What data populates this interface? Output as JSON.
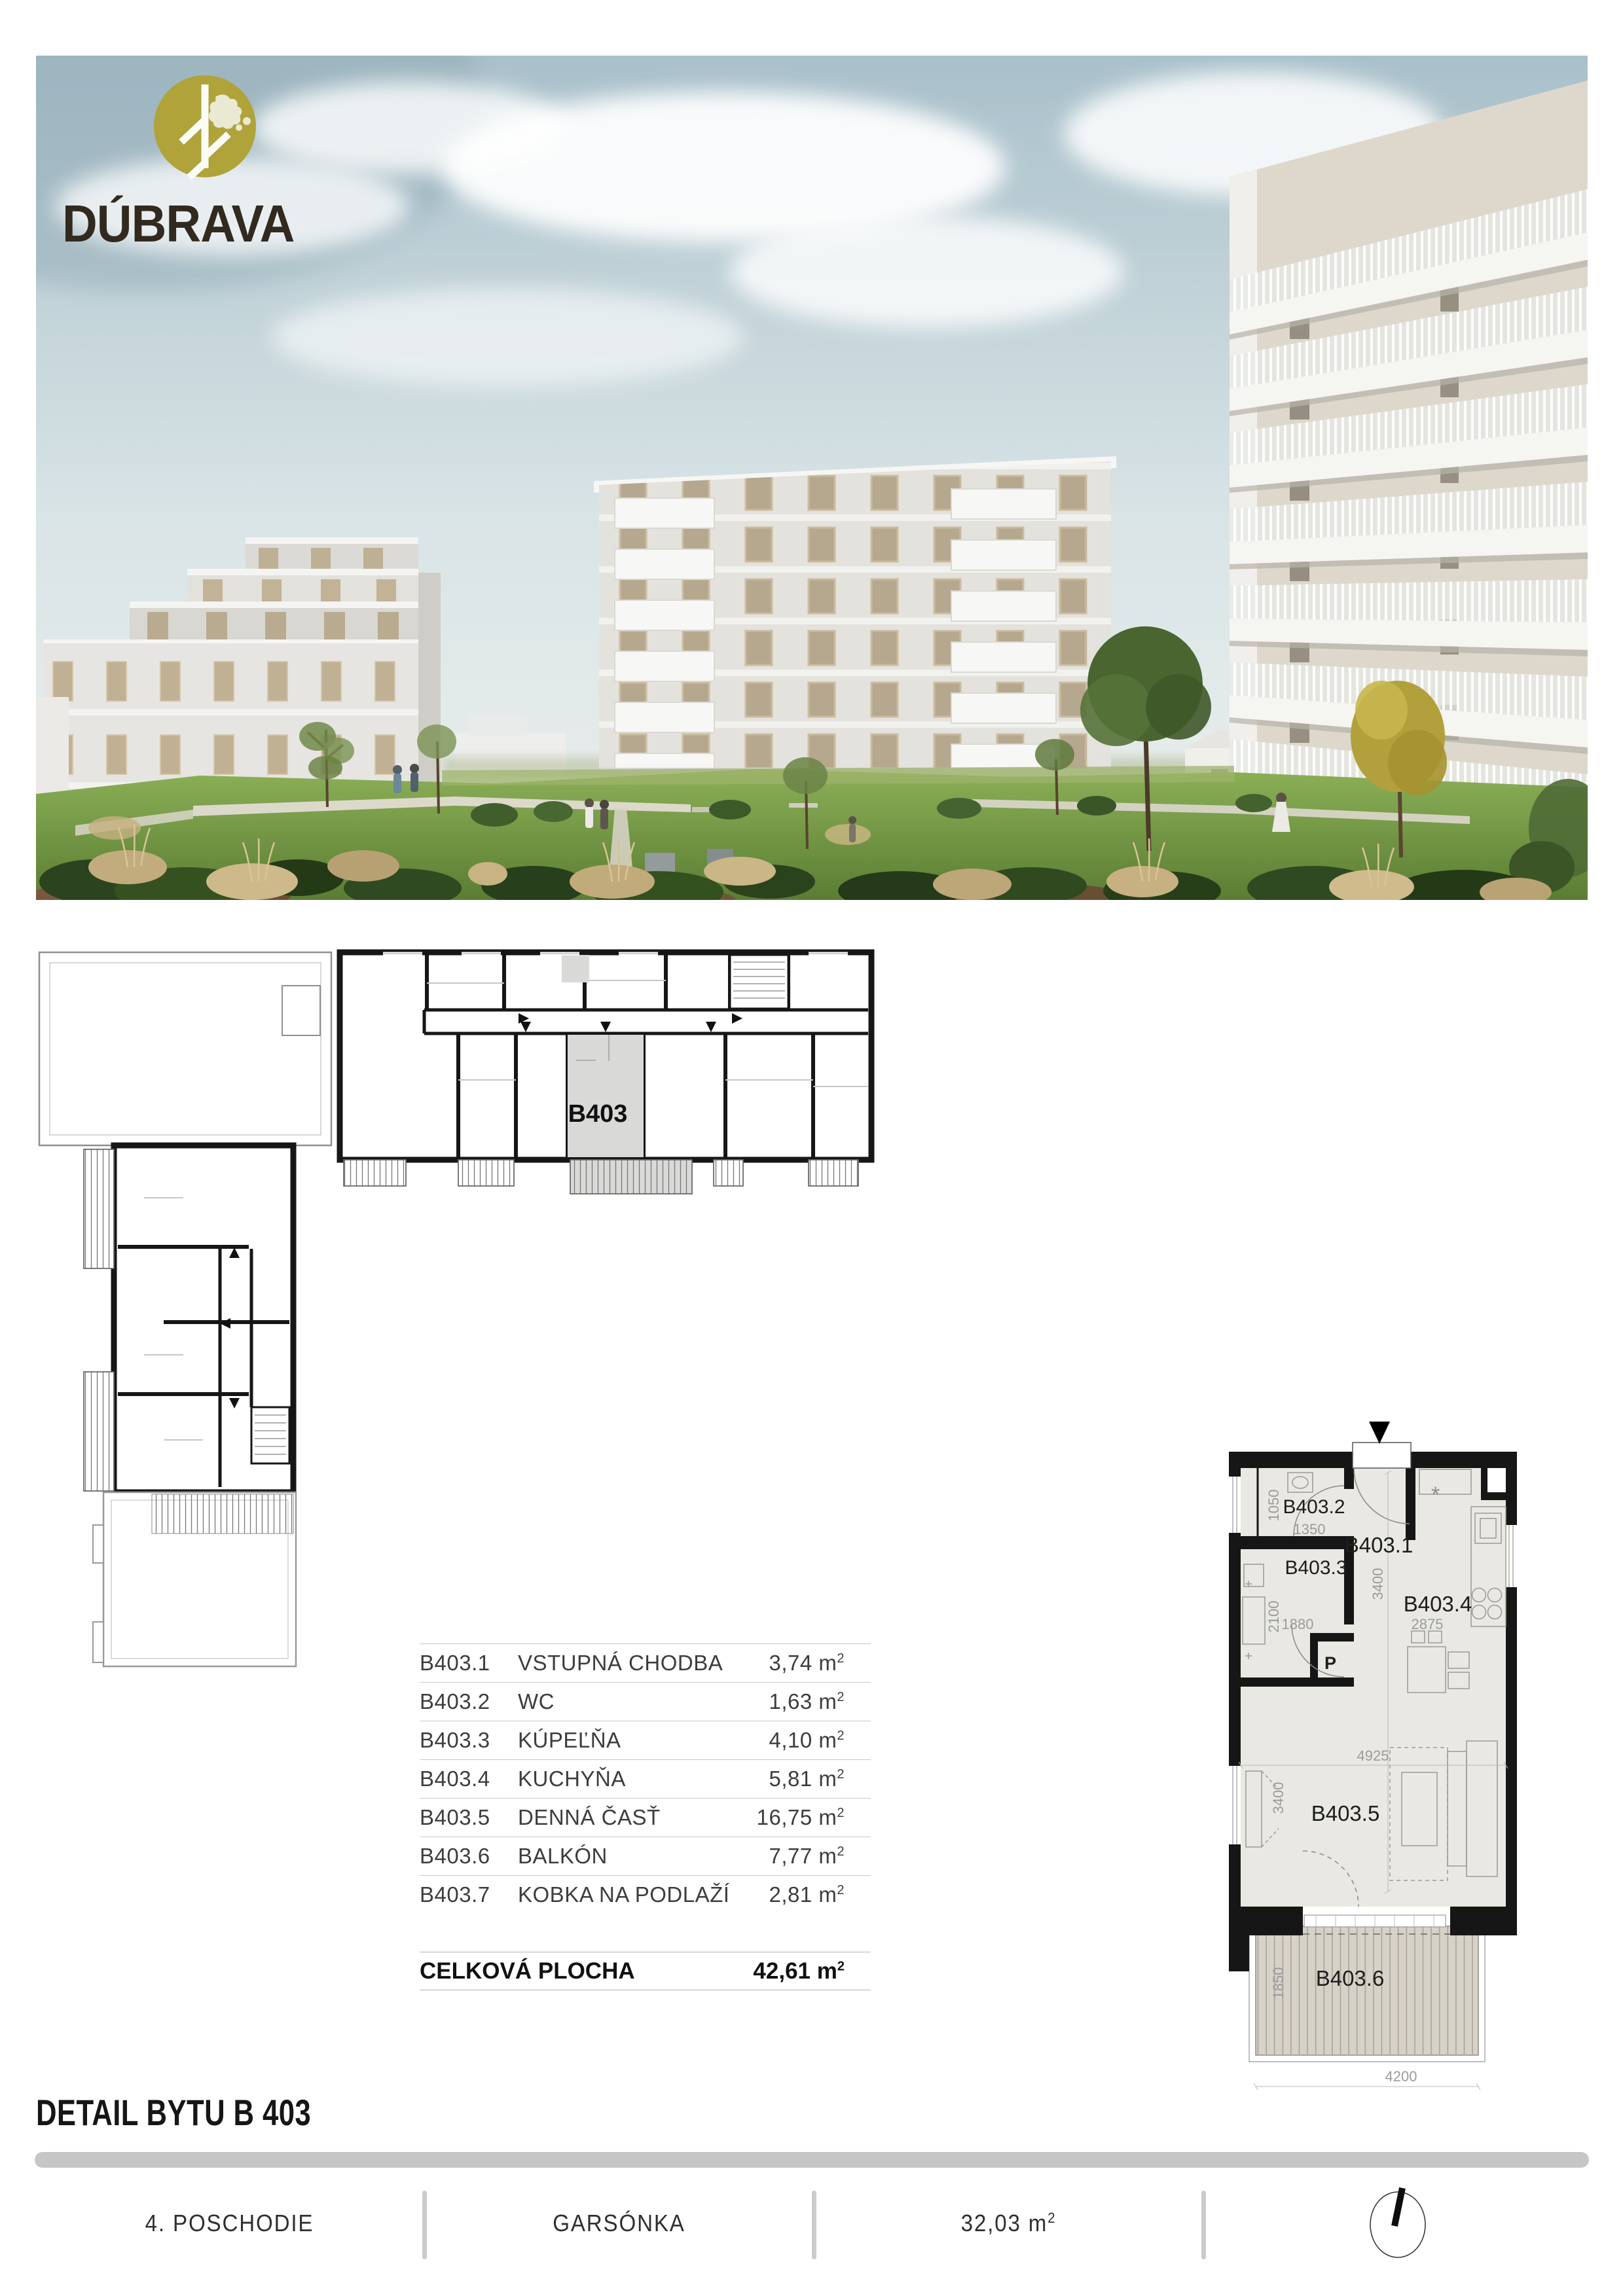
{
  "logo": {
    "brand": "DÚBRAVA",
    "mark": "tree-icon",
    "circle_color": "#b0a339",
    "text_color": "#32291f"
  },
  "overview_plan": {
    "highlight_label": "B403",
    "highlight_color": "#d9d9d7"
  },
  "detail_plan": {
    "entrance_marker": "entrance-arrow-icon",
    "labels": {
      "hall": "B403.1",
      "wc": "B403.2",
      "bath": "B403.3",
      "kitchen": "B403.4",
      "living": "B403.5",
      "balcony": "B403.6",
      "closet": "P"
    },
    "dimensions": {
      "wc_height": "1050",
      "wc_width": "1350",
      "bath_height": "2100",
      "bath_width": "1880",
      "hall_depth": "3400",
      "kitchen_width": "2875",
      "living_width": "4925",
      "living_height": "3400",
      "balcony_height": "1850",
      "balcony_width": "4200"
    },
    "colors": {
      "wall": "#161616",
      "floor": "#e9e8e3",
      "balcony_deck": "#d6d2c7"
    }
  },
  "room_table": {
    "rows": [
      {
        "code": "B403.1",
        "name": "VSTUPNÁ CHODBA",
        "area": "3,74"
      },
      {
        "code": "B403.2",
        "name": "WC",
        "area": "1,63"
      },
      {
        "code": "B403.3",
        "name": "KÚPEĽŇA",
        "area": "4,10"
      },
      {
        "code": "B403.4",
        "name": "KUCHYŇA",
        "area": "5,81"
      },
      {
        "code": "B403.5",
        "name": "DENNÁ ČASŤ",
        "area": "16,75"
      },
      {
        "code": "B403.6",
        "name": "BALKÓN",
        "area": "7,77"
      },
      {
        "code": "B403.7",
        "name": "KOBKA NA PODLAŽÍ",
        "area": "2,81"
      }
    ],
    "unit_base": "m",
    "unit_sup": "2",
    "total": {
      "label": "CELKOVÁ PLOCHA",
      "area": "42,61"
    }
  },
  "section": {
    "title": "DETAIL BYTU B 403"
  },
  "footer": {
    "floor": "4. POSCHODIE",
    "layout": "GARSÓNKA",
    "area": "32,03",
    "unit_base": "m",
    "unit_sup": "2",
    "compass": "compass-icon"
  }
}
